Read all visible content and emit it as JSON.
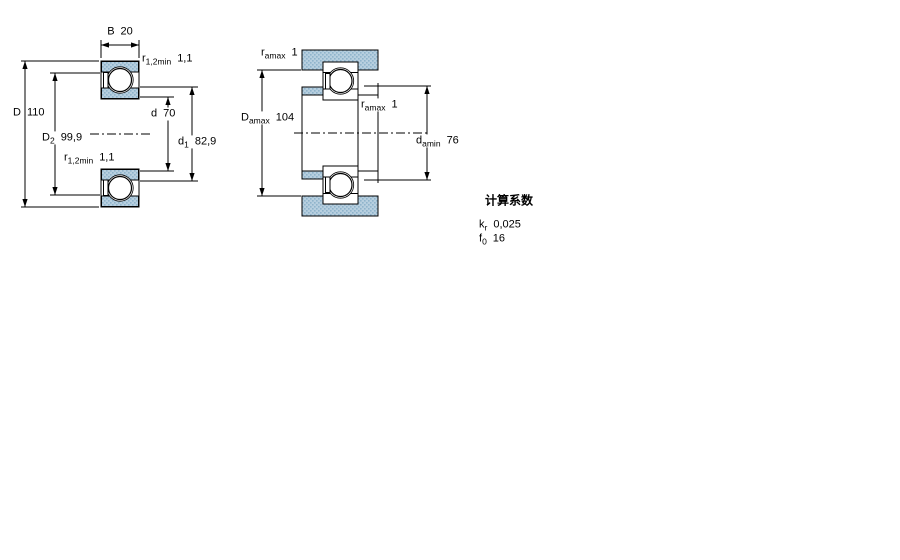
{
  "colors": {
    "line": "#000000",
    "fill_blue": "#b7cfdf",
    "fill_blue_dot": "#8fb4cb",
    "background": "#ffffff"
  },
  "left_figure": {
    "labels": {
      "b": {
        "symbol": "B",
        "value": "20"
      },
      "r12_top": {
        "symbol": "r",
        "subscript": "1,2min",
        "value": "1,1"
      },
      "D": {
        "symbol": "D",
        "value": "110"
      },
      "D2": {
        "symbol": "D",
        "subscript": "2",
        "value": "99,9"
      },
      "r12_mid": {
        "symbol": "r",
        "subscript": "1,2min",
        "value": "1,1"
      },
      "d": {
        "symbol": "d",
        "value": "70"
      },
      "d1": {
        "symbol": "d",
        "subscript": "1",
        "value": "82,9"
      }
    }
  },
  "right_figure": {
    "labels": {
      "ra_top": {
        "symbol": "r",
        "subscript": "amax",
        "value": "1"
      },
      "Da": {
        "symbol": "D",
        "subscript": "amax",
        "value": "104"
      },
      "ra_mid": {
        "symbol": "r",
        "subscript": "amax",
        "value": "1"
      },
      "da": {
        "symbol": "d",
        "subscript": "amin",
        "value": "76"
      }
    }
  },
  "calculation_factors": {
    "title": "计算系数",
    "rows": [
      {
        "symbol": "k",
        "subscript": "r",
        "value": "0,025"
      },
      {
        "symbol": "f",
        "subscript": "0",
        "value": "16"
      }
    ]
  }
}
